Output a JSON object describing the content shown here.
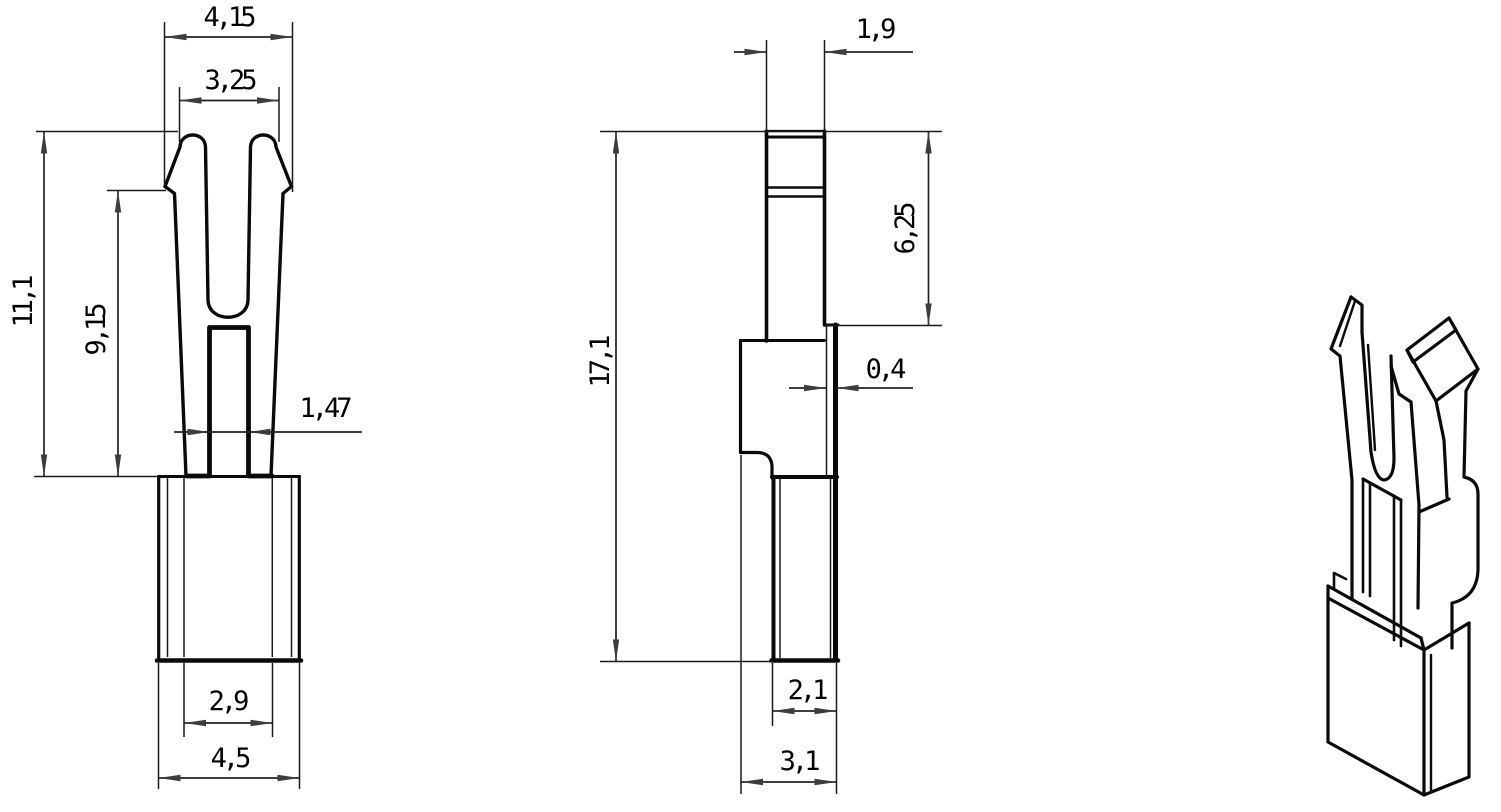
{
  "drawing": {
    "background_color": "#ffffff",
    "line_color": "#0a0a0a",
    "arrow_color": "#3d3d3d",
    "dims": {
      "front_top_width": "4,15",
      "front_tip_width": "3,25",
      "front_fork_height": "11,1",
      "front_slot_height": "9,15",
      "front_slot_width": "1,47",
      "front_body_inner_width": "2,9",
      "front_body_width": "4,5",
      "side_blade_width": "1,9",
      "side_blade_length": "6,25",
      "side_total_length": "17,1",
      "side_material_thickness": "0,4",
      "side_barrel_width": "2,1",
      "side_overall_width": "3,1"
    }
  }
}
